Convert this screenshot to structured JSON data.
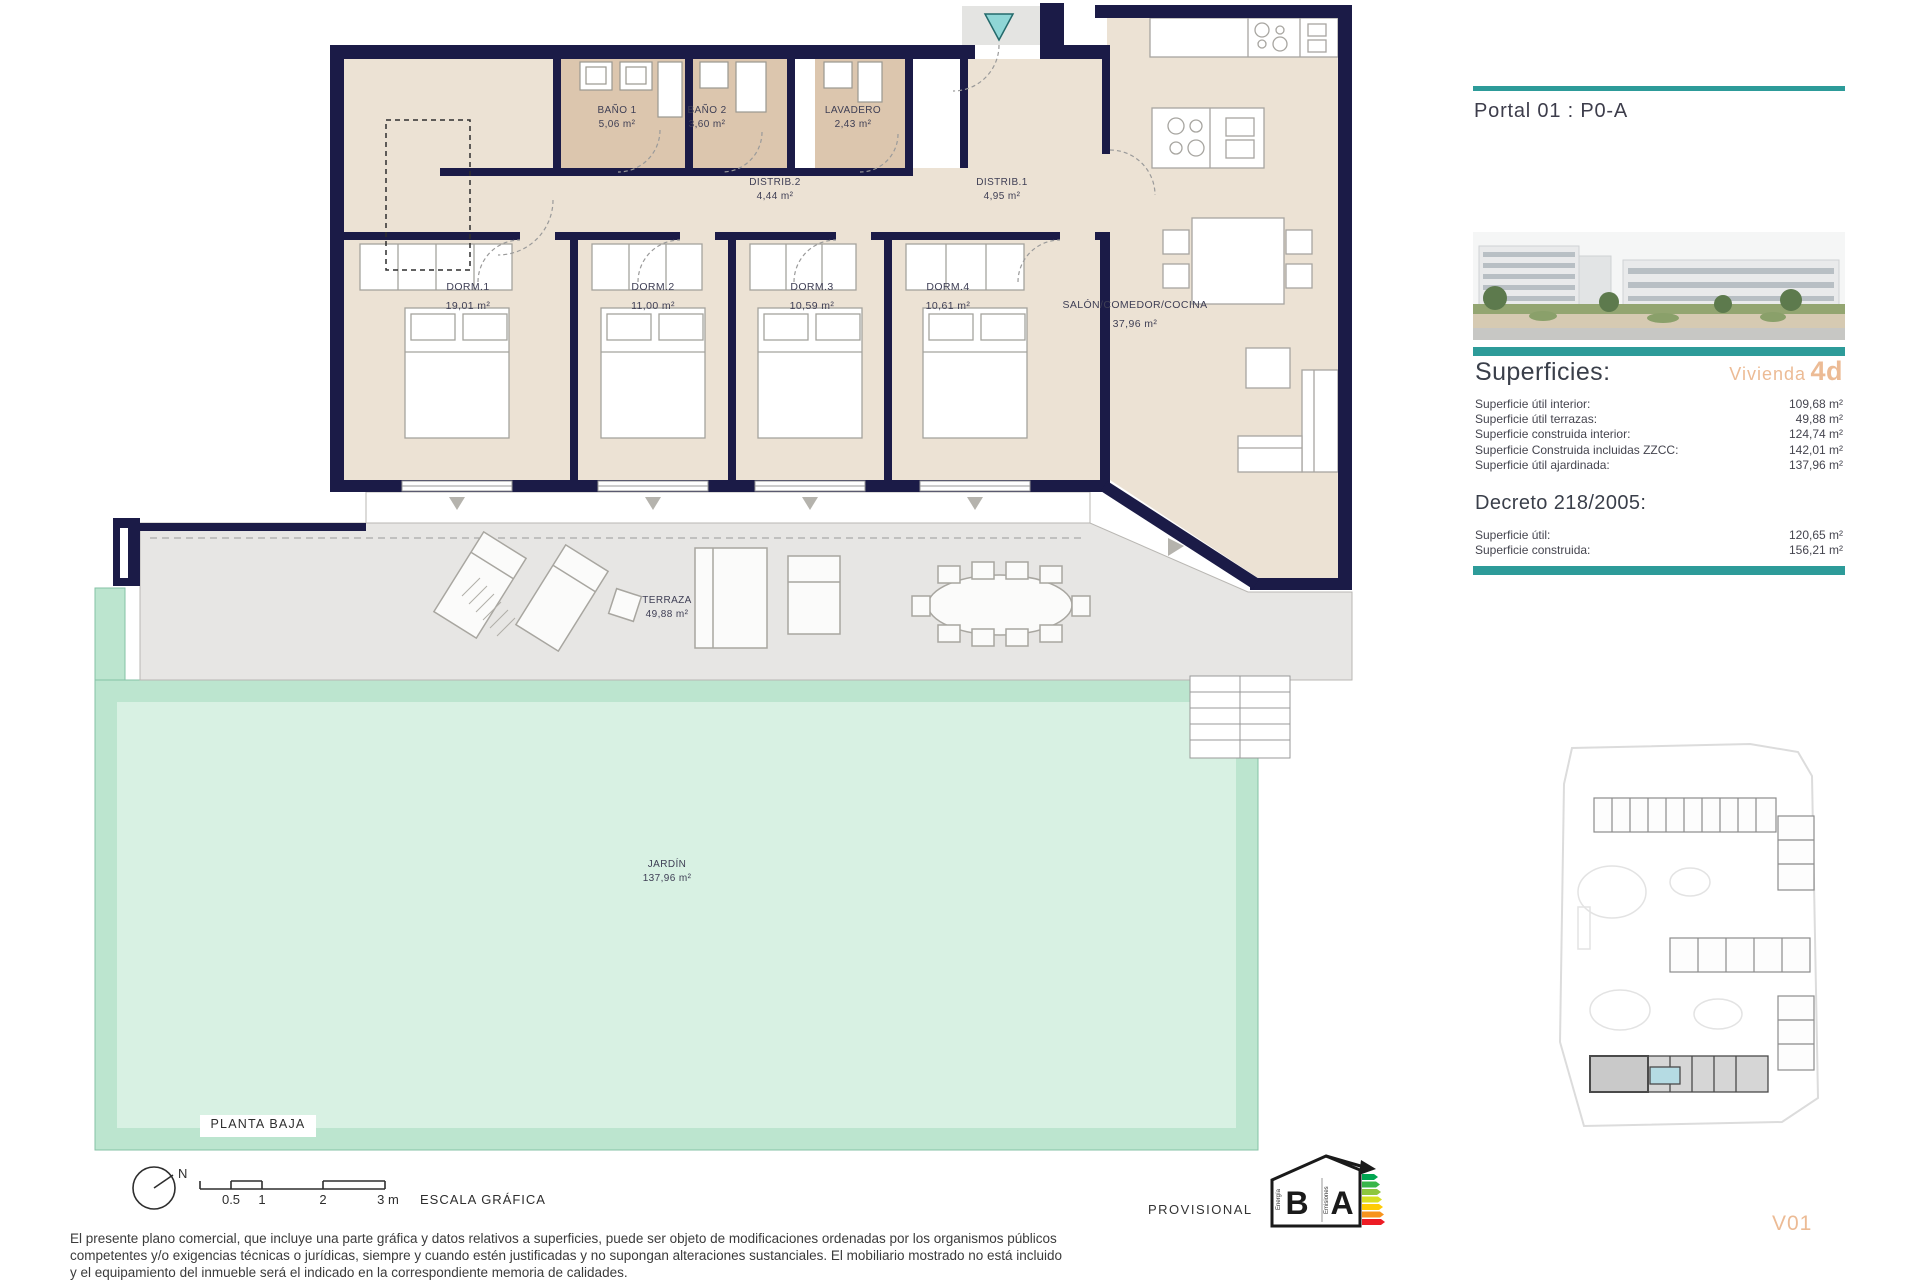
{
  "plan": {
    "floor_label": "PLANTA BAJA",
    "rooms": [
      {
        "name": "BAÑO 1",
        "area": "5,06 m²"
      },
      {
        "name": "BAÑO 2",
        "area": "3,60 m²"
      },
      {
        "name": "LAVADERO",
        "area": "2,43 m²"
      },
      {
        "name": "DISTRIB.2",
        "area": "4,44 m²"
      },
      {
        "name": "DISTRIB.1",
        "area": "4,95 m²"
      },
      {
        "name": "DORM.1",
        "area": "19,01 m²"
      },
      {
        "name": "DORM.2",
        "area": "11,00 m²"
      },
      {
        "name": "DORM.3",
        "area": "10,59 m²"
      },
      {
        "name": "DORM.4",
        "area": "10,61 m²"
      },
      {
        "name": "SALÓN/COMEDOR/COCINA",
        "area": "37,96 m²"
      },
      {
        "name": "TERRAZA",
        "area": "49,88 m²"
      },
      {
        "name": "JARDÍN",
        "area": "137,96 m²"
      }
    ]
  },
  "sidebar": {
    "portal": "Portal 01 : P0-A",
    "superficies": {
      "title": "Superficies:",
      "vivienda_label": "Vivienda",
      "vivienda_code": "4d",
      "rows": [
        {
          "label": "Superficie útil interior:",
          "value": "109,68 m²"
        },
        {
          "label": "Superficie útil terrazas:",
          "value": "49,88 m²"
        },
        {
          "label": "Superficie construida interior:",
          "value": "124,74 m²"
        },
        {
          "label": "Superficie Construida incluidas ZZCC:",
          "value": "142,01 m²"
        },
        {
          "label": "Superficie útil ajardinada:",
          "value": "137,96 m²"
        }
      ]
    },
    "decreto": {
      "title": "Decreto 218/2005:",
      "rows": [
        {
          "label": "Superficie útil:",
          "value": "120,65 m²"
        },
        {
          "label": "Superficie construida:",
          "value": "156,21 m²"
        }
      ]
    }
  },
  "footer": {
    "compass_n": "N",
    "scale": {
      "tick_05": "0.5",
      "tick_1": "1",
      "tick_2": "2",
      "tick_3": "3 m",
      "caption": "ESCALA GRÁFICA"
    },
    "provisional": "PROVISIONAL",
    "version": "V01",
    "energy": {
      "letter_left": "B",
      "letter_right": "A",
      "caption_left": "Energía",
      "caption_right": "Emisiones"
    },
    "disclaimer_line1": "El presente plano comercial, que incluye una parte gráfica y datos relativos a superficies, puede ser objeto de modificaciones ordenadas por los organismos públicos",
    "disclaimer_line2": "competentes y/o exigencias técnicas o jurídicas, siempre y cuando estén justificadas y no supongan alteraciones sustanciales. El mobiliario mostrado no está incluido",
    "disclaimer_line3": "y el equipamiento del inmueble será el indicado en la correspondiente memoria de calidades."
  },
  "colors": {
    "wall_navy": "#1b1b47",
    "room_beige": "#ece2d4",
    "bath_tan": "#dcc6ae",
    "terrace_gray": "#e7e6e4",
    "garden_mint": "#bce5cf",
    "garden_mint_light": "#d8f1e3",
    "accent_teal": "#2d9b99",
    "accent_orange": "#ecbb95",
    "site_highlight_blue": "#b5dbe3"
  }
}
